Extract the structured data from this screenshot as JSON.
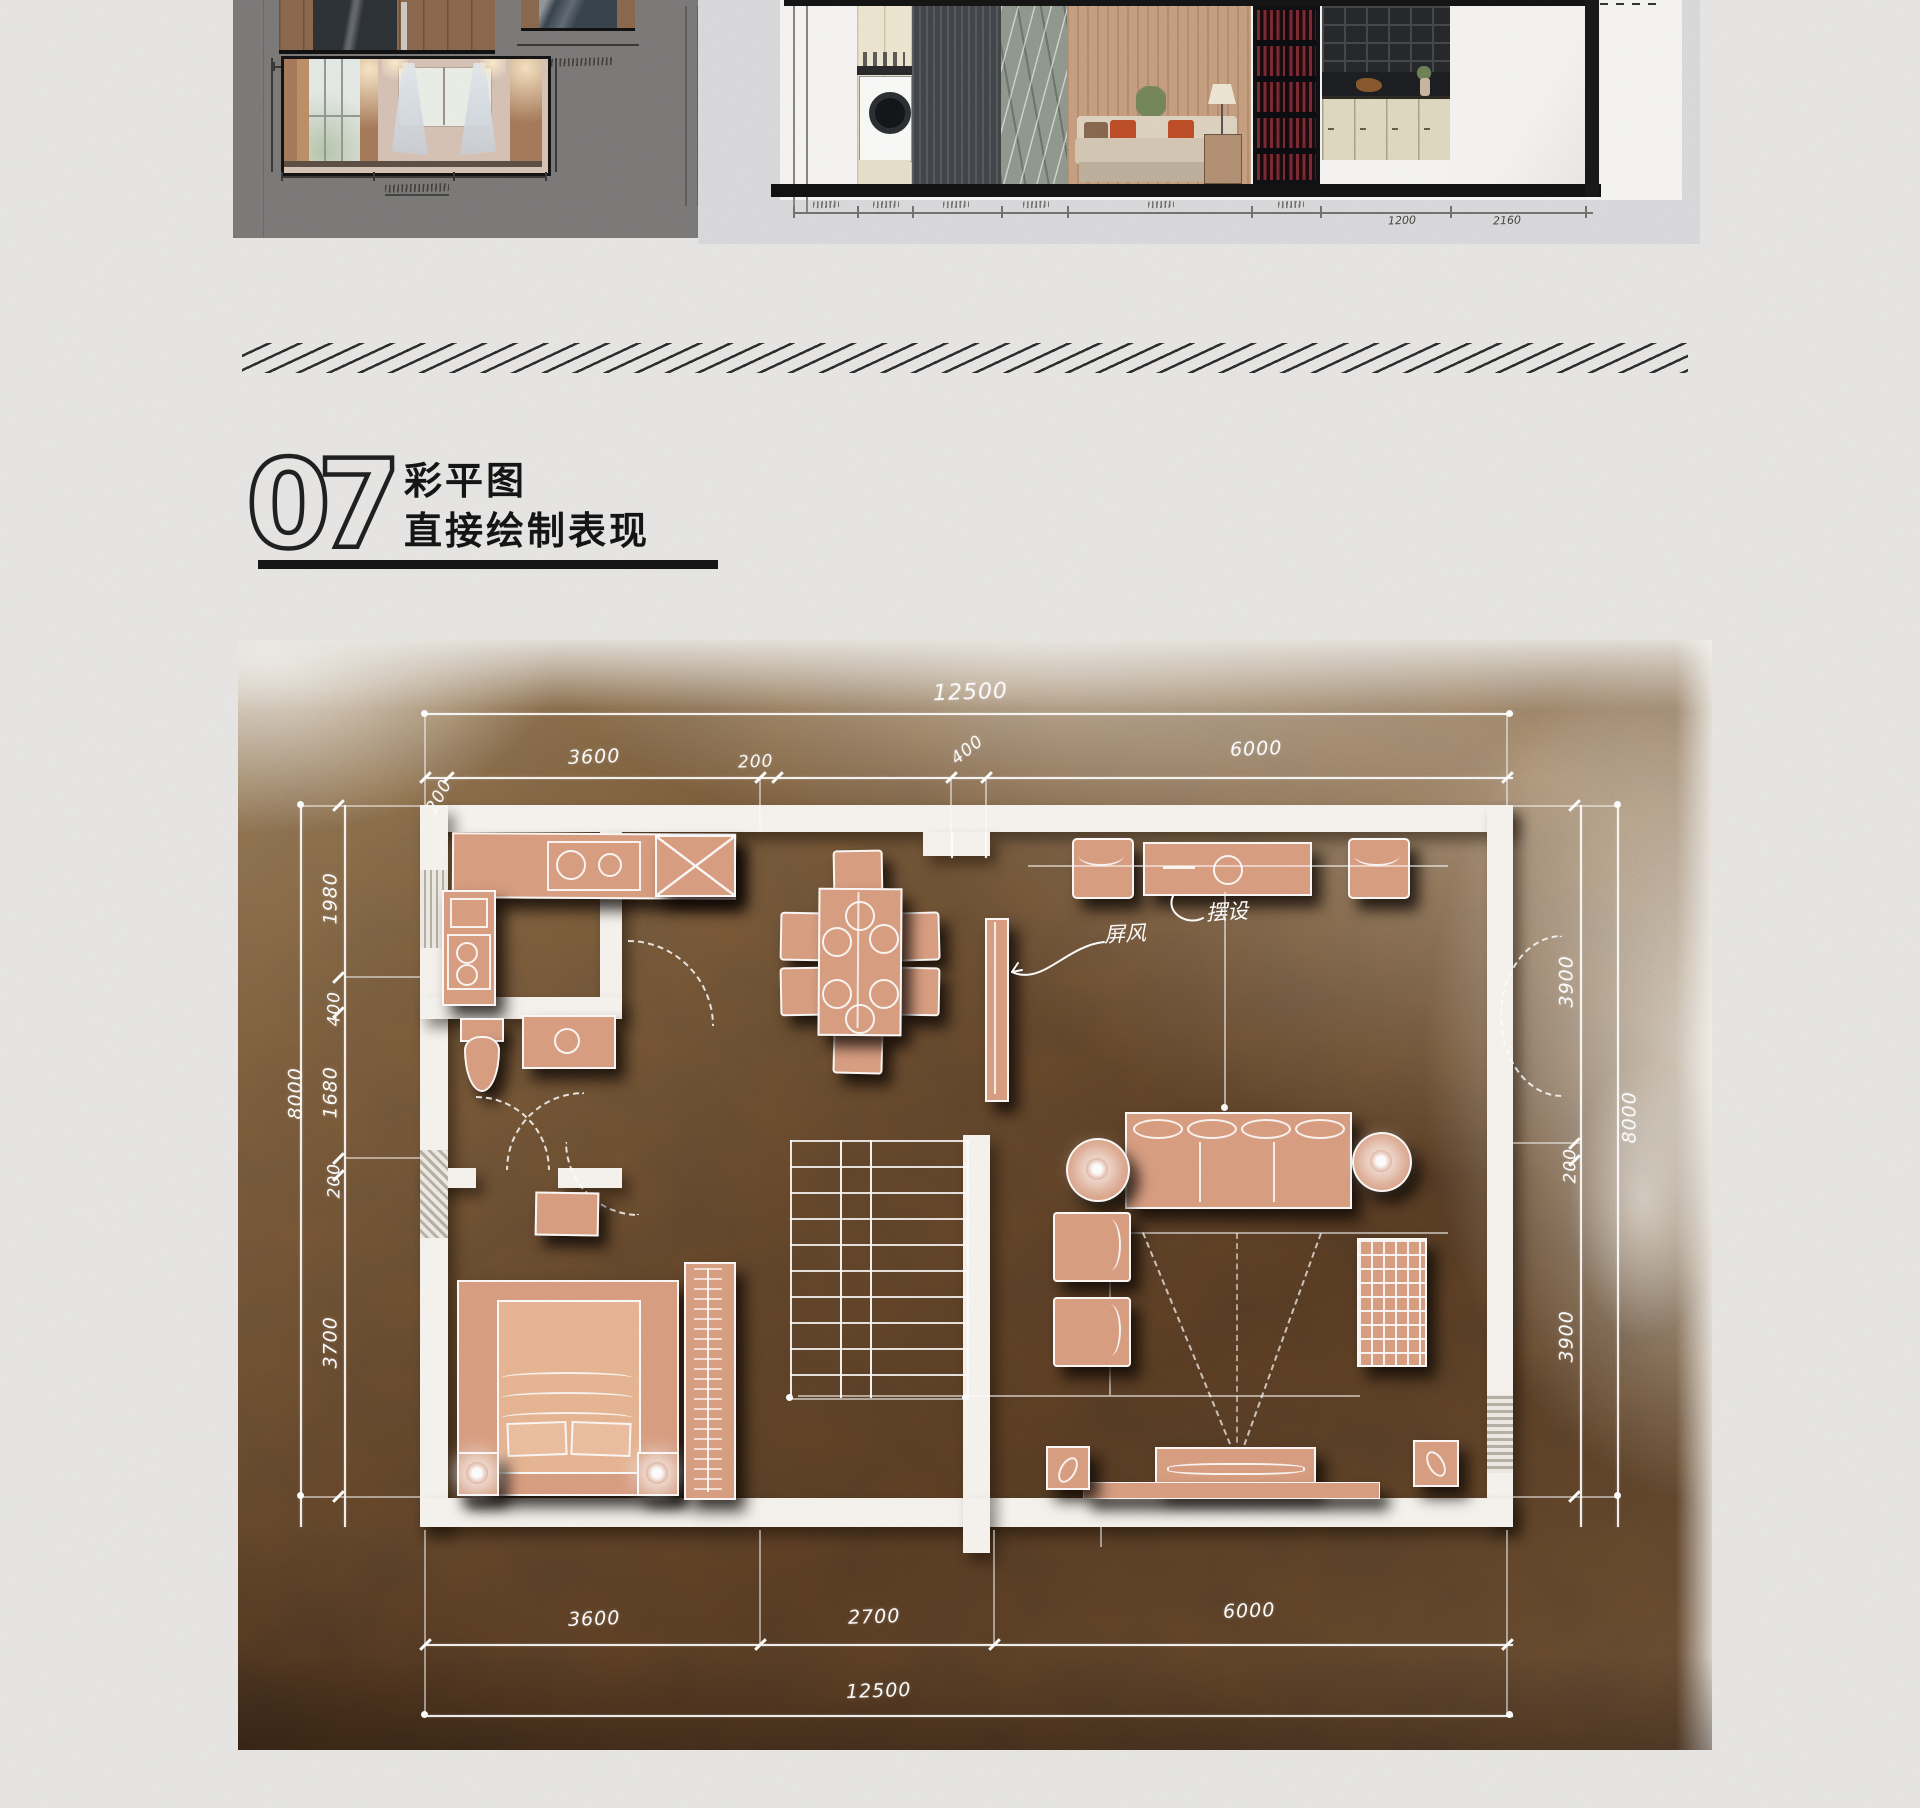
{
  "header": {
    "section_number": "07",
    "title_line1": "彩平图",
    "title_line2": "直接绘制表现"
  },
  "elevations": {
    "right_panel_dim_labels": [
      "1200",
      "2160"
    ]
  },
  "plan": {
    "dims": {
      "top_overall": "12500",
      "top_segments": [
        "200",
        "3600",
        "200",
        "400",
        "6000"
      ],
      "left_overall": "8000",
      "left_segments": [
        "1980",
        "400",
        "1680",
        "200",
        "3700"
      ],
      "right_overall": "8000",
      "right_segments": [
        "3900",
        "200",
        "3900"
      ],
      "bottom_segments": [
        "3600",
        "2700",
        "6000"
      ],
      "bottom_overall": "12500"
    },
    "annotations": {
      "screen": "屏风",
      "console": "摆设"
    }
  },
  "colors": {
    "page_bg": "#e9e8e6",
    "panel_gray": "#7e7c7b",
    "panel_light": "#dcdcde",
    "plan_dark": "#57402a",
    "plan_light": "#a18a74",
    "furniture": "#dba083",
    "wall_white": "#f8f5f0",
    "accent_orange": "#bf4f28",
    "ink": "#1c1c1c",
    "dim_white": "#ffffff"
  }
}
